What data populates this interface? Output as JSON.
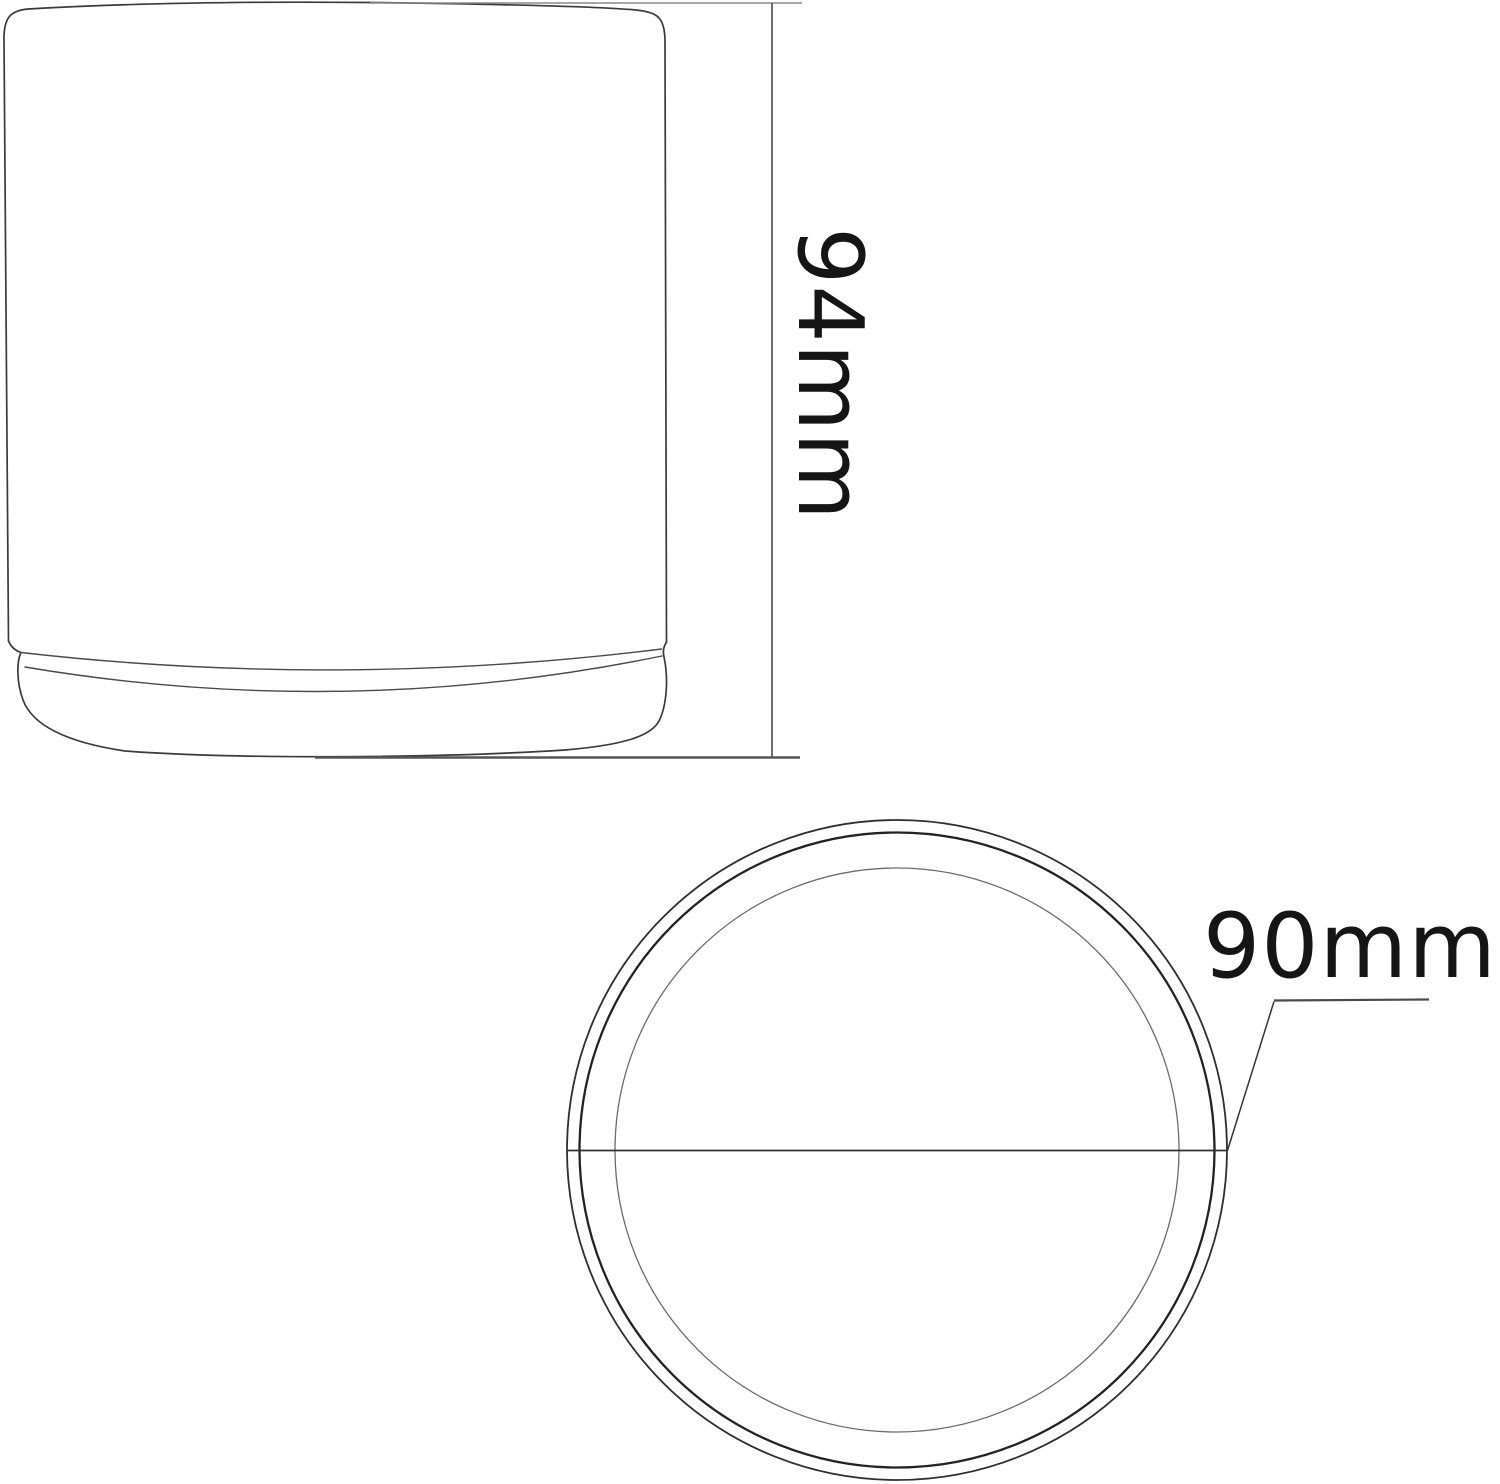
{
  "side_view": {
    "height_label": "94mm",
    "height_value_mm": 94,
    "unit": "mm"
  },
  "bottom_view": {
    "diameter_label": "90mm",
    "diameter_value_mm": 90,
    "unit": "mm"
  },
  "colors": {
    "background": "#ffffff",
    "outline": "#3a3a3a",
    "dimension_lines": "#555555",
    "label_text": "#151515"
  }
}
